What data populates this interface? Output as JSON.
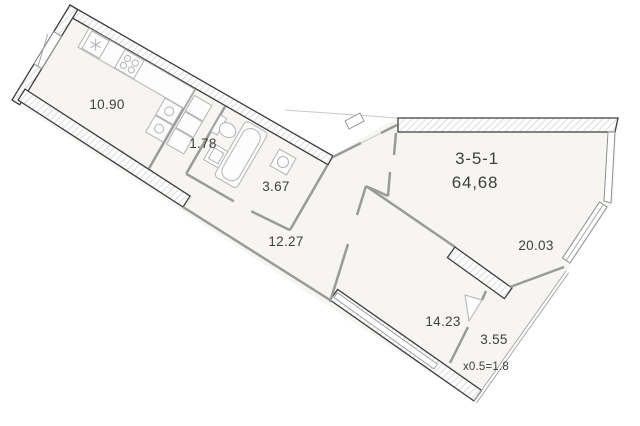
{
  "plan": {
    "unit_id": "3-5-1",
    "total_area": "64,68",
    "rooms": {
      "kitchen_living": "10.90",
      "corridor": "1.78",
      "bathroom": "3.67",
      "hall": "12.27",
      "living_room": "20.03",
      "bedroom": "14.23",
      "balcony": "3.55",
      "balcony_coef": "x0.5=1.8"
    },
    "colors": {
      "wall": "#3d3d3d",
      "interior_wall": "#9a9a9a",
      "room_fill": "#f6f5f2",
      "hatch": "#c6c6c6",
      "text": "#3f3f3f",
      "fixture": "#b3b3b3"
    }
  }
}
